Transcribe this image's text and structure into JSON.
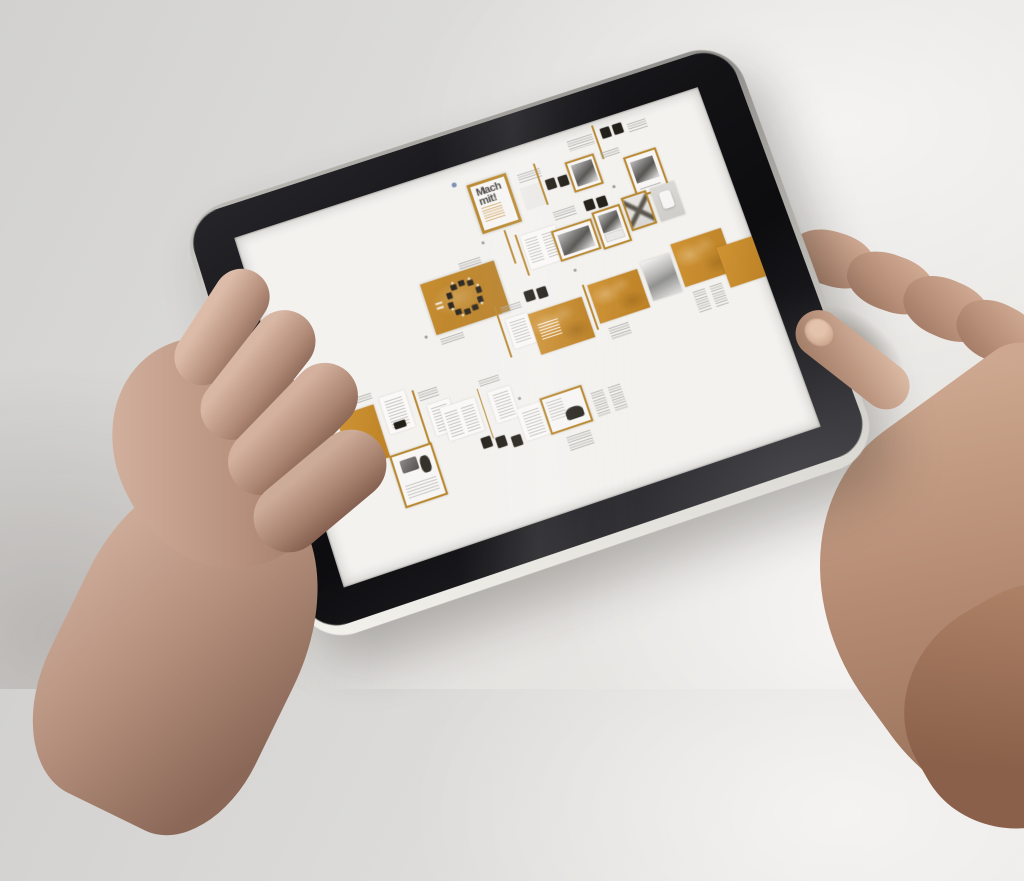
{
  "scene": {
    "description": "Two hands holding a black tablet in landscape; the screen shows a magazine design flatplan of small page thumbnails",
    "wall_color": "#e0dfdd",
    "table_highlight": "#efede9"
  },
  "tablet": {
    "bezel_color": "#131316",
    "edge_color": "#dcdad5",
    "screen_color": "#f3f2ef",
    "home_button": "home-button"
  },
  "screen": {
    "cover_title": "Mach mit!",
    "accent_orange": "#c48a2b",
    "items": [
      {
        "type": "dot",
        "name": "blue-mark",
        "x": 45.4,
        "y": 4.4,
        "w": 0.9,
        "h": 1.3,
        "c": "#7a8fb5"
      },
      {
        "type": "caption",
        "name": "caption-block",
        "x": 70.5,
        "y": 3.2,
        "w": 5.5,
        "h": 3
      },
      {
        "type": "blk",
        "name": "photo-thumb",
        "x": 77.8,
        "y": 2.8,
        "w": 2,
        "h": 3
      },
      {
        "type": "blk",
        "name": "photo-thumb",
        "x": 80.4,
        "y": 2.8,
        "w": 2,
        "h": 3
      },
      {
        "type": "divv",
        "name": "divider-line",
        "x": 76.4,
        "y": 1.2,
        "w": 0.4,
        "h": 10
      },
      {
        "type": "caption",
        "name": "caption-block",
        "x": 83.5,
        "y": 3.8,
        "w": 4,
        "h": 2.4
      },
      {
        "type": "cover",
        "name": "cover-page-mach-mit",
        "x": 48.2,
        "y": 6.2,
        "w": 8.4,
        "h": 14.4
      },
      {
        "type": "caption",
        "name": "caption-block",
        "x": 58.6,
        "y": 7.8,
        "w": 5,
        "h": 2.6
      },
      {
        "type": "pgfaint",
        "name": "page-thumbnail",
        "x": 58.2,
        "y": 11.8,
        "w": 4.6,
        "h": 6.4
      },
      {
        "type": "blk",
        "name": "photo-thumb",
        "x": 63.8,
        "y": 11.8,
        "w": 2,
        "h": 3
      },
      {
        "type": "blk",
        "name": "photo-thumb",
        "x": 66.4,
        "y": 12.1,
        "w": 2,
        "h": 3
      },
      {
        "type": "divv",
        "name": "divider-line",
        "x": 62.6,
        "y": 6.4,
        "w": 0.4,
        "h": 12
      },
      {
        "type": "framedphoto",
        "v": "v-sq",
        "name": "framed-photo-page",
        "x": 68.8,
        "y": 8.8,
        "w": 6.2,
        "h": 8.8
      },
      {
        "type": "caption",
        "name": "caption-block",
        "x": 76.2,
        "y": 9.4,
        "w": 4,
        "h": 2
      },
      {
        "type": "framedphoto",
        "v": "v-tall",
        "name": "framed-photo-page",
        "x": 80.4,
        "y": 12.6,
        "w": 7,
        "h": 12
      },
      {
        "type": "divv",
        "name": "divider-line",
        "x": 52.4,
        "y": 21.4,
        "w": 0.4,
        "h": 10
      },
      {
        "type": "caption",
        "name": "caption-block",
        "x": 63.2,
        "y": 21,
        "w": 4.6,
        "h": 2.6
      },
      {
        "type": "blk",
        "name": "photo-thumb",
        "x": 69.8,
        "y": 20.6,
        "w": 2,
        "h": 3
      },
      {
        "type": "blk",
        "name": "photo-thumb",
        "x": 72.4,
        "y": 20.9,
        "w": 2,
        "h": 3
      },
      {
        "type": "lines2",
        "name": "text-spread",
        "x": 55.2,
        "y": 24.6,
        "w": 7.6,
        "h": 9.6
      },
      {
        "type": "divv",
        "name": "divider-line",
        "x": 54.2,
        "y": 23.6,
        "w": 0.4,
        "h": 12
      },
      {
        "type": "framedphoto",
        "v": "v-land",
        "name": "framed-photo-page",
        "x": 61.4,
        "y": 26,
        "w": 8.8,
        "h": 8.8
      },
      {
        "type": "framedphoto",
        "v": "v-tall2",
        "name": "framed-photo-page",
        "x": 70.6,
        "y": 24.6,
        "w": 6,
        "h": 10.8
      },
      {
        "type": "framedx",
        "name": "framed-pattern-page",
        "x": 77.2,
        "y": 23.2,
        "w": 5.4,
        "h": 9.8
      },
      {
        "type": "grayrect",
        "name": "gray-page",
        "x": 83.4,
        "y": 23.2,
        "w": 5.4,
        "h": 9.8
      },
      {
        "type": "chairs",
        "name": "orange-table-scene-page",
        "x": 32.8,
        "y": 28.6,
        "w": 15.8,
        "h": 14.6
      },
      {
        "type": "caption",
        "name": "caption-block",
        "x": 41.6,
        "y": 26.4,
        "w": 4.6,
        "h": 2
      },
      {
        "type": "caption",
        "name": "caption-block",
        "x": 33.2,
        "y": 44.6,
        "w": 5,
        "h": 2.4
      },
      {
        "type": "divv",
        "name": "divider-line",
        "x": 45.6,
        "y": 40.6,
        "w": 0.4,
        "h": 15
      },
      {
        "type": "caption",
        "name": "caption-block",
        "x": 46.8,
        "y": 41.6,
        "w": 4.2,
        "h": 2.4
      },
      {
        "type": "lines1",
        "name": "text-page",
        "x": 47,
        "y": 45.2,
        "w": 4.6,
        "h": 8.6
      },
      {
        "type": "blk",
        "name": "photo-thumb",
        "x": 52.2,
        "y": 39.6,
        "w": 2,
        "h": 3
      },
      {
        "type": "blk",
        "name": "photo-thumb",
        "x": 54.8,
        "y": 39.9,
        "w": 2,
        "h": 3
      },
      {
        "type": "orangetitle",
        "name": "orange-spread-with-title",
        "x": 51.6,
        "y": 45.8,
        "w": 11.6,
        "h": 11.6
      },
      {
        "type": "divv",
        "name": "divider-line",
        "x": 64,
        "y": 42.8,
        "w": 0.4,
        "h": 13
      },
      {
        "type": "orangetex",
        "name": "orange-spread",
        "x": 65,
        "y": 43.4,
        "w": 10.6,
        "h": 11.2
      },
      {
        "type": "gradp",
        "name": "gradient-page",
        "x": 76.6,
        "y": 42,
        "w": 6.2,
        "h": 11.2
      },
      {
        "type": "orangetex",
        "name": "orange-spread",
        "x": 83.6,
        "y": 39.8,
        "w": 11,
        "h": 12.4
      },
      {
        "type": "orange",
        "name": "orange-page",
        "x": 92.4,
        "y": 44.8,
        "w": 7.6,
        "h": 11.5
      },
      {
        "type": "captioncols",
        "name": "caption-columns",
        "x": 84.6,
        "y": 54.2,
        "w": 6.4,
        "h": 6.4
      },
      {
        "type": "caption",
        "name": "caption-block",
        "x": 66.2,
        "y": 56.4,
        "w": 4.2,
        "h": 3.6
      },
      {
        "type": "caption",
        "name": "caption-block",
        "x": 11.8,
        "y": 52.6,
        "w": 5,
        "h": 2.2
      },
      {
        "type": "orange",
        "name": "orange-page",
        "x": 8.6,
        "y": 55.8,
        "w": 8,
        "h": 15
      },
      {
        "type": "lines1",
        "name": "text-page",
        "x": 18,
        "y": 54.8,
        "w": 5.2,
        "h": 10.4
      },
      {
        "type": "blk",
        "name": "photo-thumb",
        "x": 19.2,
        "y": 62.4,
        "w": 2.4,
        "h": 1.8
      },
      {
        "type": "divv",
        "name": "divider-line",
        "x": 24.6,
        "y": 55.6,
        "w": 0.4,
        "h": 15
      },
      {
        "type": "caption",
        "name": "caption-block",
        "x": 25.6,
        "y": 56.8,
        "w": 4,
        "h": 2.2
      },
      {
        "type": "lines1",
        "name": "text-page",
        "x": 26.6,
        "y": 60.8,
        "w": 4.6,
        "h": 8.6
      },
      {
        "type": "framed",
        "name": "framed-collage-page",
        "x": 16.4,
        "y": 70.6,
        "w": 8.8,
        "h": 14.6,
        "extra": "framedcollage"
      },
      {
        "type": "lines2",
        "name": "text-spread",
        "x": 28.8,
        "y": 62.8,
        "w": 7.2,
        "h": 9.2
      },
      {
        "type": "divv",
        "name": "divider-line",
        "x": 37,
        "y": 60.8,
        "w": 0.4,
        "h": 14
      },
      {
        "type": "caption",
        "name": "caption-block",
        "x": 38,
        "y": 58.8,
        "w": 4.2,
        "h": 2.2
      },
      {
        "type": "lines1",
        "name": "text-page",
        "x": 39,
        "y": 62.8,
        "w": 4.6,
        "h": 8.6
      },
      {
        "type": "blk",
        "name": "photo-thumb",
        "x": 34.6,
        "y": 73.8,
        "w": 2,
        "h": 3
      },
      {
        "type": "blk",
        "name": "photo-thumb",
        "x": 37.6,
        "y": 74.9,
        "w": 2,
        "h": 3
      },
      {
        "type": "blk",
        "name": "photo-thumb",
        "x": 40.6,
        "y": 76,
        "w": 2,
        "h": 3
      },
      {
        "type": "lines1",
        "name": "text-page",
        "x": 43.4,
        "y": 69.6,
        "w": 5,
        "h": 9
      },
      {
        "type": "framed",
        "name": "framed-car-page",
        "x": 48.4,
        "y": 68.6,
        "w": 8.8,
        "h": 10.4,
        "extra": "framedcar"
      },
      {
        "type": "captioncols",
        "name": "caption-columns",
        "x": 58.4,
        "y": 71.6,
        "w": 6.4,
        "h": 7
      },
      {
        "type": "caption",
        "name": "caption-block",
        "x": 51,
        "y": 81,
        "w": 5,
        "h": 4
      },
      {
        "type": "dot",
        "name": "page-number-dot",
        "x": 47.4,
        "y": 22.6,
        "w": 0.6,
        "h": 0.8,
        "c": "#9a9894"
      },
      {
        "type": "dot",
        "name": "page-number-dot",
        "x": 30.4,
        "y": 42.6,
        "w": 0.6,
        "h": 0.8,
        "c": "#9a9894"
      },
      {
        "type": "dot",
        "name": "page-number-dot",
        "x": 9.4,
        "y": 52.2,
        "w": 0.6,
        "h": 0.8,
        "c": "#9a9894"
      },
      {
        "type": "dot",
        "name": "page-number-dot",
        "x": 63.4,
        "y": 37.8,
        "w": 0.6,
        "h": 0.8,
        "c": "#9a9894"
      },
      {
        "type": "dot",
        "name": "page-number-dot",
        "x": 76.4,
        "y": 19.2,
        "w": 0.6,
        "h": 0.8,
        "c": "#9a9894"
      },
      {
        "type": "dot",
        "name": "page-number-dot",
        "x": 44.4,
        "y": 66.4,
        "w": 0.6,
        "h": 0.8,
        "c": "#9a9894"
      }
    ]
  }
}
